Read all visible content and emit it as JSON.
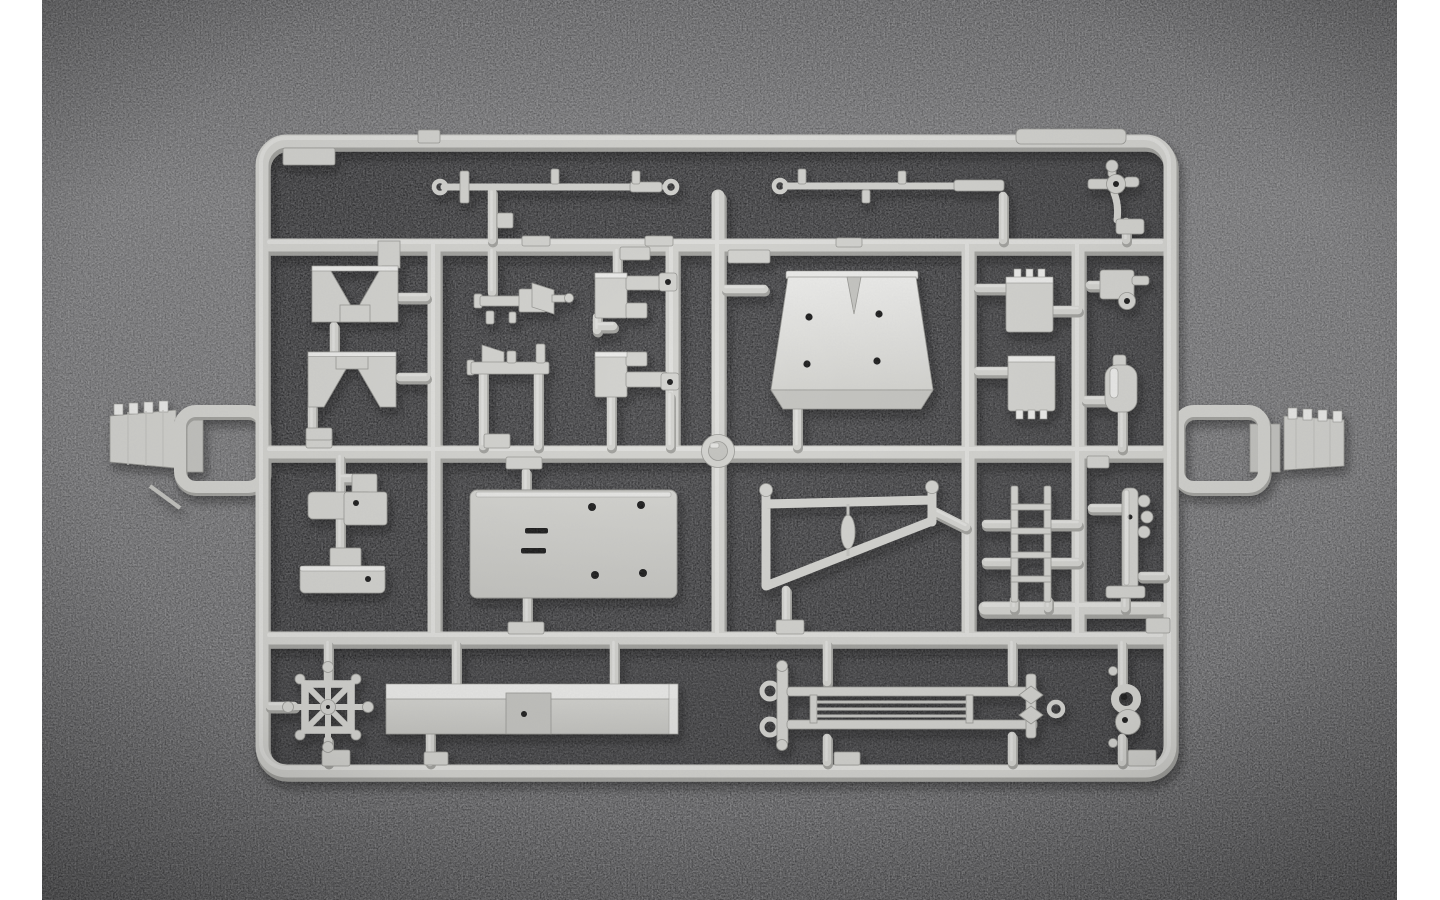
{
  "scene": {
    "type": "product-photograph",
    "description": "Light grey injection-moulded model kit sprue (parts tree) lying on a dark grey mottled backdrop, photographed straight on; white vertical strips border the photo on the left and right edges",
    "photo": {
      "left_strip_width": 42,
      "right_strip_start": 1397,
      "backdrop": "dark mottled grey, darker inside the sprue frame",
      "no_visible_text": true
    }
  },
  "colors": {
    "page_bg": "#ffffff",
    "backdrop_top": "#59595b",
    "backdrop_mid": "#6e6e70",
    "backdrop_low": "#626264",
    "backdrop_bottom": "#4c4c4e",
    "inner_bg": "#2e2e30",
    "inner_bg_edge": "#3a3a3c",
    "plastic": "#d4d4d0",
    "plastic_highlight": "#ededeb",
    "plastic_mid": "#c5c5c1",
    "plastic_shadow": "#a2a29e",
    "plastic_edge": "#989894",
    "hole": "#1d1d1f",
    "grain": "#8d8d8f"
  },
  "sprue": {
    "material": "light grey styrene",
    "frame": {
      "shape": "rounded rectangle",
      "x": 262,
      "y": 141,
      "width": 908,
      "height": 630
    },
    "injection_hub": {
      "shape": "round disc",
      "cx": 718,
      "cy": 451
    },
    "side_gates": [
      {
        "name": "sprue-gate-left",
        "desc": "ridged feed plug with open rectangular loop",
        "side": "left"
      },
      {
        "name": "sprue-gate-right",
        "desc": "ridged feed plug with open rectangular loop",
        "side": "right"
      }
    ],
    "parts": [
      {
        "name": "axle-rod-a",
        "desc": "long thin rod, eyelet both ends, mounting nubs",
        "cell": "top-left"
      },
      {
        "name": "axle-rod-b",
        "desc": "long thin rod, eyelet left end, thick collar right",
        "cell": "top-right"
      },
      {
        "name": "cross-fitting",
        "desc": "small cross-shaped fitting with centre hole",
        "cell": "top-right"
      },
      {
        "name": "saddle-bracket-upper",
        "desc": "U-shaped mounting yoke",
        "cell": "row2-left"
      },
      {
        "name": "saddle-bracket-lower",
        "desc": "inverted U-shaped mounting yoke",
        "cell": "row2-left"
      },
      {
        "name": "mg-mount-upper",
        "desc": "machine-gun shaped mount, barrel left",
        "cell": "row2-middle"
      },
      {
        "name": "mg-mount-lower",
        "desc": "machine-gun shaped mount, barrel left",
        "cell": "row2-middle"
      },
      {
        "name": "angle-bracket-upper",
        "desc": "Z-bracket with eyelet pad",
        "cell": "row2-middle"
      },
      {
        "name": "angle-bracket-lower",
        "desc": "Z-bracket with eyelet pad",
        "cell": "row2-middle"
      },
      {
        "name": "hull-box",
        "desc": "large tapered box panel, four locating holes, V notch",
        "cell": "row2-right"
      },
      {
        "name": "stowage-box-upper",
        "desc": "small box with three hinge pins on top",
        "cell": "row2-right"
      },
      {
        "name": "stowage-box-lower",
        "desc": "small box with three hinge pins below",
        "cell": "row2-right"
      },
      {
        "name": "latch-fitting",
        "desc": "small bracket with side pin and eyelet boss",
        "cell": "row2-far-right"
      },
      {
        "name": "bottle-fitting",
        "desc": "capsule shaped fitting",
        "cell": "row2-far-right"
      },
      {
        "name": "pistol-bracket-upper",
        "desc": "L-bracket with pin hole",
        "cell": "row3-left"
      },
      {
        "name": "pistol-bracket-lower",
        "desc": "mirrored L-bracket with pin hole",
        "cell": "row3-left"
      },
      {
        "name": "floor-plate",
        "desc": "large rectangular plate, four holes, two slots",
        "cell": "row3-middle"
      },
      {
        "name": "wedge-frame",
        "desc": "tapered open frame with centre spindle",
        "cell": "row3-right"
      },
      {
        "name": "ladder",
        "desc": "short ladder, two rails, four rungs",
        "cell": "row3-right"
      },
      {
        "name": "stanchion",
        "desc": "post with three side pegs and foot plate",
        "cell": "row3-far-right"
      },
      {
        "name": "helm-wheel",
        "desc": "square-rim wheel, eight ball-tipped handles",
        "cell": "row4-left"
      },
      {
        "name": "hull-beam",
        "desc": "long beam with recessed centre notch",
        "cell": "row4-middle"
      },
      {
        "name": "towing-frame",
        "desc": "long railing, eyelet rings left, finial right, three tie rods",
        "cell": "row4-right"
      },
      {
        "name": "twin-ring",
        "desc": "figure-eight double ring fitting",
        "cell": "row4-far-right"
      }
    ]
  }
}
